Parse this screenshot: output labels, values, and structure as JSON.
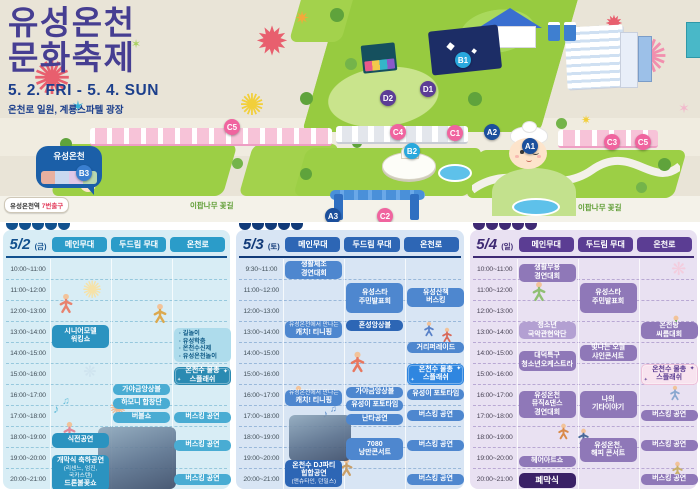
{
  "poster": {
    "title_line1": "유성온천",
    "title_line2": "문화축제",
    "date_range": "5. 2. FRI - 5. 4. SUN",
    "venue": "온천로 일원, 계룡스파텔 광장"
  },
  "map": {
    "bubble_label": "유성온천",
    "station_name": "유성온천역",
    "station_exit": "7번출구",
    "flower_road_label": "이팝나무 꽃길",
    "markers": [
      {
        "id": "B3",
        "x": 84,
        "y": 173,
        "color": "#3a7fd0"
      },
      {
        "id": "C5",
        "x": 232,
        "y": 127,
        "color": "#f0649f"
      },
      {
        "id": "A3",
        "x": 333,
        "y": 216,
        "color": "#1b4f9c"
      },
      {
        "id": "C2",
        "x": 385,
        "y": 216,
        "color": "#f0649f"
      },
      {
        "id": "D2",
        "x": 388,
        "y": 98,
        "color": "#5c3d96"
      },
      {
        "id": "D1",
        "x": 428,
        "y": 89,
        "color": "#5c3d96"
      },
      {
        "id": "C4",
        "x": 398,
        "y": 132,
        "color": "#f0649f"
      },
      {
        "id": "C1",
        "x": 455,
        "y": 133,
        "color": "#f0649f"
      },
      {
        "id": "B2",
        "x": 412,
        "y": 151,
        "color": "#29a8dd"
      },
      {
        "id": "B1",
        "x": 463,
        "y": 60,
        "color": "#29a8dd"
      },
      {
        "id": "A2",
        "x": 492,
        "y": 132,
        "color": "#1b4f9c"
      },
      {
        "id": "A1",
        "x": 530,
        "y": 146,
        "color": "#1b4f9c"
      },
      {
        "id": "C3",
        "x": 612,
        "y": 142,
        "color": "#f0649f"
      },
      {
        "id": "C5",
        "x": 643,
        "y": 142,
        "color": "#f0649f"
      }
    ],
    "fireworks": [
      {
        "g": "✺",
        "x": 52,
        "y": 78,
        "s": 46,
        "c": "#e85f6e"
      },
      {
        "g": "✶",
        "x": 78,
        "y": 108,
        "s": 16,
        "c": "#35b0d8"
      },
      {
        "g": "✹",
        "x": 272,
        "y": 42,
        "s": 40,
        "c": "#e85f6e"
      },
      {
        "g": "✷",
        "x": 302,
        "y": 18,
        "s": 18,
        "c": "#f2a93b"
      },
      {
        "g": "✺",
        "x": 252,
        "y": 106,
        "s": 30,
        "c": "#f2cf3a"
      },
      {
        "g": "✺",
        "x": 648,
        "y": 58,
        "s": 48,
        "c": "#f28fae"
      },
      {
        "g": "✹",
        "x": 614,
        "y": 24,
        "s": 22,
        "c": "#e85f6e"
      },
      {
        "g": "✶",
        "x": 684,
        "y": 108,
        "s": 14,
        "c": "#f2b8cc"
      },
      {
        "g": "✶",
        "x": 136,
        "y": 44,
        "s": 12,
        "c": "#a8d060"
      },
      {
        "g": "✷",
        "x": 586,
        "y": 120,
        "s": 12,
        "c": "#f2cf3a"
      }
    ]
  },
  "tables": [
    {
      "day": "5/2",
      "dow": "(금)",
      "columns": [
        "메인무대",
        "두드림 무대",
        "온천로"
      ],
      "times": [
        "10:00~11:00",
        "11:00~12:00",
        "12:00~13:00",
        "13:00~14:00",
        "14:00~15:00",
        "15:00~16:00",
        "16:00~17:00",
        "17:00~18:00",
        "18:00~19:00",
        "19:00~20:00",
        "20:00~21:00"
      ],
      "splash_icon": "✦",
      "theme": {
        "bg": "#d8edf5",
        "day": "#12518e",
        "head": "#2b9cc9",
        "line": "#12518e",
        "chip": "#49acd3",
        "chip2": "#2b93c0",
        "light": "#aedcec",
        "listText": "#0f5a86",
        "splashBg": "#2a8ab2",
        "splashText": "#ffffff",
        "dash": "#96c8dd",
        "time": "#44525c",
        "darkc": "#12518e"
      },
      "events": [
        {
          "c": 0,
          "r": 3.05,
          "s": 1.25,
          "t": "box2",
          "lines": [
            "시니어모델",
            "워킹쇼"
          ]
        },
        {
          "c": 0,
          "r": 8.2,
          "s": 0.85,
          "t": "box2",
          "lines": [
            "식전공연"
          ]
        },
        {
          "c": 0,
          "r": 9.25,
          "s": 1.85,
          "t": "box2",
          "lines": [
            "개막식 축하공연",
            "~(리센느, 엄진,",
            "~국카스텐)",
            "드론불꽃쇼"
          ]
        },
        {
          "c": 1,
          "r": 5.9,
          "s": 0.6,
          "t": "box",
          "lines": [
            "가야금앙상블"
          ]
        },
        {
          "c": 1,
          "r": 6.55,
          "s": 0.6,
          "t": "box",
          "lines": [
            "하모니 합창단"
          ]
        },
        {
          "c": 1,
          "r": 7.2,
          "s": 0.6,
          "t": "box",
          "lines": [
            "버블쇼"
          ]
        },
        {
          "c": 2,
          "r": 3.2,
          "s": 1.8,
          "t": "list",
          "lines": [
            "· 길놀이",
            "· 유성학춤",
            "· 온천수신제",
            "· 유성온천놀이"
          ]
        },
        {
          "c": 2,
          "r": 5.05,
          "s": 1.0,
          "t": "splash",
          "lines": [
            "온천수 물총",
            "스플래쉬"
          ]
        },
        {
          "c": 2,
          "r": 7.2,
          "s": 0.6,
          "t": "box",
          "lines": [
            "버스킹 공연"
          ]
        },
        {
          "c": 2,
          "r": 8.55,
          "s": 0.6,
          "t": "box",
          "lines": [
            "버스킹 공연"
          ]
        },
        {
          "c": 2,
          "r": 10.15,
          "s": 0.6,
          "t": "box",
          "lines": [
            "버스킹 공연"
          ]
        }
      ],
      "doodles": [
        {
          "kind": "glyph",
          "g": "✺",
          "x": 86,
          "y": 32,
          "s": 24,
          "c": "#f6e2a8"
        },
        {
          "kind": "glyph",
          "g": "✶",
          "x": 84,
          "y": 84,
          "s": 15,
          "c": "#f3d88e"
        },
        {
          "kind": "glyph",
          "g": "❋",
          "x": 84,
          "y": 114,
          "s": 16,
          "c": "#cfe4ef"
        },
        {
          "kind": "glyph",
          "g": "♪",
          "x": 50,
          "y": 150,
          "s": 12,
          "c": "#62bcd8"
        },
        {
          "kind": "glyph",
          "g": "♫",
          "x": 60,
          "y": 143,
          "s": 10,
          "c": "#62bcd8"
        },
        {
          "kind": "glyph",
          "g": "✺",
          "x": 112,
          "y": 150,
          "s": 20,
          "c": "#f2b890"
        },
        {
          "kind": "person",
          "x": 52,
          "y": 34,
          "s": 16,
          "c": "#e8836f"
        },
        {
          "kind": "person",
          "x": 146,
          "y": 44,
          "s": 16,
          "c": "#dca94e"
        },
        {
          "kind": "person",
          "x": 56,
          "y": 162,
          "s": 15,
          "c": "#e08898"
        },
        {
          "kind": "photo",
          "x": 92,
          "y": 168,
          "w": 78,
          "h": 62
        }
      ]
    },
    {
      "day": "5/3",
      "dow": "(토)",
      "columns": [
        "메인무대",
        "두드림 무대",
        "온천로"
      ],
      "times": [
        "9:30~11:00",
        "11:00~12:00",
        "12:00~13:00",
        "13:00~14:00",
        "14:00~15:00",
        "15:00~16:00",
        "16:00~17:00",
        "17:00~18:00",
        "18:00~19:00",
        "19:00~20:00",
        "20:00~21:00"
      ],
      "splash_icon": "✦",
      "theme": {
        "bg": "#d8e5f4",
        "day": "#113a78",
        "head": "#2d66b5",
        "line": "#113a78",
        "chip": "#4e87cf",
        "chip2": "#2d66b5",
        "light": "#a8c6e8",
        "listText": "#113a78",
        "splashBg": "#2f86e0",
        "splashText": "#ffffff",
        "dash": "#99b8da",
        "time": "#44525c",
        "darkc": "#113a78"
      },
      "events": [
        {
          "c": 0,
          "r": 0.0,
          "s": 1.0,
          "t": "box",
          "lines": [
            "생활체조",
            "경연대회"
          ]
        },
        {
          "c": 0,
          "r": 2.9,
          "s": 0.95,
          "t": "box",
          "lines": [
            "~유성온천에서 만나는",
            "캐치! 티니핑"
          ]
        },
        {
          "c": 0,
          "r": 6.15,
          "s": 0.9,
          "t": "box",
          "lines": [
            "~유성온천에서 만나는",
            "캐치! 티니핑"
          ]
        },
        {
          "c": 0,
          "r": 9.5,
          "s": 1.45,
          "t": "box2",
          "lines": [
            "온천수 DJ파티",
            "힙합공연",
            "~(앤슈타인, 던밀스)"
          ]
        },
        {
          "c": 1,
          "r": 1.05,
          "s": 1.6,
          "t": "box",
          "lines": [
            "유성스타",
            "주민발표회"
          ]
        },
        {
          "c": 1,
          "r": 2.85,
          "s": 0.6,
          "t": "box2",
          "lines": [
            "혼성앙상블"
          ]
        },
        {
          "c": 1,
          "r": 6.0,
          "s": 0.6,
          "t": "box",
          "lines": [
            "가야금앙상블"
          ]
        },
        {
          "c": 1,
          "r": 6.65,
          "s": 0.6,
          "t": "box",
          "lines": [
            "유성이 포토타임"
          ]
        },
        {
          "c": 1,
          "r": 7.3,
          "s": 0.65,
          "t": "box",
          "lines": [
            "난타공연"
          ]
        },
        {
          "c": 1,
          "r": 8.45,
          "s": 1.2,
          "t": "box",
          "lines": [
            "7080",
            "낭만콘서트"
          ]
        },
        {
          "c": 2,
          "r": 1.3,
          "s": 1.05,
          "t": "box",
          "lines": [
            "유성산책",
            "버스킹"
          ]
        },
        {
          "c": 2,
          "r": 3.9,
          "s": 0.6,
          "t": "box",
          "lines": [
            "거리퍼레이드"
          ]
        },
        {
          "c": 2,
          "r": 4.95,
          "s": 1.1,
          "t": "splash",
          "lines": [
            "온천수 물총",
            "스플래쉬"
          ]
        },
        {
          "c": 2,
          "r": 6.1,
          "s": 0.6,
          "t": "box",
          "lines": [
            "유성이 포토타임"
          ]
        },
        {
          "c": 2,
          "r": 7.1,
          "s": 0.6,
          "t": "box",
          "lines": [
            "버스킹 공연"
          ]
        },
        {
          "c": 2,
          "r": 8.55,
          "s": 0.6,
          "t": "box",
          "lines": [
            "버스킹 공연"
          ]
        },
        {
          "c": 2,
          "r": 10.15,
          "s": 0.6,
          "t": "box",
          "lines": [
            "버스킹 공연"
          ]
        }
      ],
      "doodles": [
        {
          "kind": "person",
          "x": 110,
          "y": 92,
          "s": 17,
          "c": "#e8775f"
        },
        {
          "kind": "person",
          "x": 52,
          "y": 126,
          "s": 15,
          "c": "#7fb868"
        },
        {
          "kind": "person",
          "x": 100,
          "y": 198,
          "s": 15,
          "c": "#c9a06a"
        },
        {
          "kind": "person",
          "x": 184,
          "y": 62,
          "s": 12,
          "c": "#5a82c8"
        },
        {
          "kind": "person",
          "x": 202,
          "y": 68,
          "s": 12,
          "c": "#d86a5a"
        },
        {
          "kind": "glyph",
          "g": "♪",
          "x": 86,
          "y": 156,
          "s": 11,
          "c": "#5a8cc8"
        },
        {
          "kind": "glyph",
          "g": "♫",
          "x": 94,
          "y": 150,
          "s": 9,
          "c": "#5a8cc8"
        },
        {
          "kind": "photo",
          "x": 50,
          "y": 156,
          "w": 62,
          "h": 46
        }
      ]
    },
    {
      "day": "5/4",
      "dow": "(일)",
      "columns": [
        "메인무대",
        "두드림 무대",
        "온천로"
      ],
      "times": [
        "10:00~11:00",
        "11:00~12:00",
        "12:00~13:00",
        "13:00~14:00",
        "14:00~15:00",
        "15:00~16:00",
        "16:00~17:00",
        "17:00~18:00",
        "18:00~19:00",
        "19:00~20:00",
        "20:00~21:00"
      ],
      "splash_icon": "✦",
      "theme": {
        "bg": "#e9e1f2",
        "day": "#3f2a74",
        "head": "#5b3d93",
        "line": "#3f2a74",
        "chip": "#8f78b8",
        "chip2": "#6d51a0",
        "light": "#b3a0d2",
        "listText": "#3f2a74",
        "splashBg": "#f8e3ef",
        "splashText": "#5b3d93",
        "splashBorder": "#eec2da",
        "dash": "#b9a8d4",
        "time": "#4a4456",
        "darkc": "#3a2166"
      },
      "events": [
        {
          "c": 0,
          "r": 0.15,
          "s": 1.0,
          "t": "box",
          "lines": [
            "생활무용",
            "경연대회"
          ]
        },
        {
          "c": 0,
          "r": 2.95,
          "s": 0.95,
          "t": "light",
          "lines": [
            "청소년",
            "국악관현악단"
          ]
        },
        {
          "c": 0,
          "r": 4.3,
          "s": 1.1,
          "t": "box",
          "lines": [
            "대덕특구",
            "청소년오케스트라"
          ]
        },
        {
          "c": 0,
          "r": 6.2,
          "s": 1.45,
          "t": "box",
          "lines": [
            "유성온천",
            "뮤직&댄스",
            "경연대회"
          ]
        },
        {
          "c": 0,
          "r": 9.3,
          "s": 0.7,
          "t": "box",
          "lines": [
            "헤어아트쇼"
          ]
        },
        {
          "c": 0,
          "r": 10.1,
          "s": 0.9,
          "t": "dark",
          "lines": [
            "폐막식"
          ]
        },
        {
          "c": 1,
          "r": 1.05,
          "s": 1.6,
          "t": "box",
          "lines": [
            "유성스타",
            "주민발표회"
          ]
        },
        {
          "c": 1,
          "r": 4.0,
          "s": 0.95,
          "t": "box",
          "lines": [
            "빛나는 오월",
            "샤인콘서트"
          ]
        },
        {
          "c": 1,
          "r": 6.2,
          "s": 1.45,
          "t": "box",
          "lines": [
            "나의",
            "기타이야기"
          ]
        },
        {
          "c": 1,
          "r": 8.45,
          "s": 1.3,
          "t": "box",
          "lines": [
            "유성온천,",
            "해피 콘서트"
          ]
        },
        {
          "c": 2,
          "r": 2.95,
          "s": 0.95,
          "t": "box",
          "lines": [
            "온천탕",
            "씨름대회"
          ]
        },
        {
          "c": 2,
          "r": 4.95,
          "s": 1.1,
          "t": "splash",
          "lines": [
            "온천수 물총",
            "스플래쉬"
          ]
        },
        {
          "c": 2,
          "r": 7.1,
          "s": 0.6,
          "t": "box",
          "lines": [
            "버스킹 공연"
          ]
        },
        {
          "c": 2,
          "r": 8.55,
          "s": 0.6,
          "t": "box",
          "lines": [
            "버스킹 공연"
          ]
        },
        {
          "c": 2,
          "r": 10.15,
          "s": 0.6,
          "t": "box",
          "lines": [
            "버스킹 공연"
          ]
        }
      ],
      "doodles": [
        {
          "kind": "person",
          "x": 58,
          "y": 22,
          "s": 16,
          "c": "#8fbf72"
        },
        {
          "kind": "person",
          "x": 196,
          "y": 56,
          "s": 14,
          "c": "#6fae58"
        },
        {
          "kind": "person",
          "x": 84,
          "y": 164,
          "s": 13,
          "c": "#d98a4a"
        },
        {
          "kind": "person",
          "x": 104,
          "y": 169,
          "s": 13,
          "c": "#4a6a9a"
        },
        {
          "kind": "person",
          "x": 196,
          "y": 126,
          "s": 12,
          "c": "#8aa8d0"
        },
        {
          "kind": "person",
          "x": 198,
          "y": 202,
          "s": 13,
          "c": "#c9b06a"
        },
        {
          "kind": "glyph",
          "g": "❋",
          "x": 206,
          "y": 10,
          "s": 18,
          "c": "#f3cdde"
        },
        {
          "kind": "glyph",
          "g": "✺",
          "x": 118,
          "y": 198,
          "s": 16,
          "c": "#cdbce4"
        }
      ]
    }
  ]
}
